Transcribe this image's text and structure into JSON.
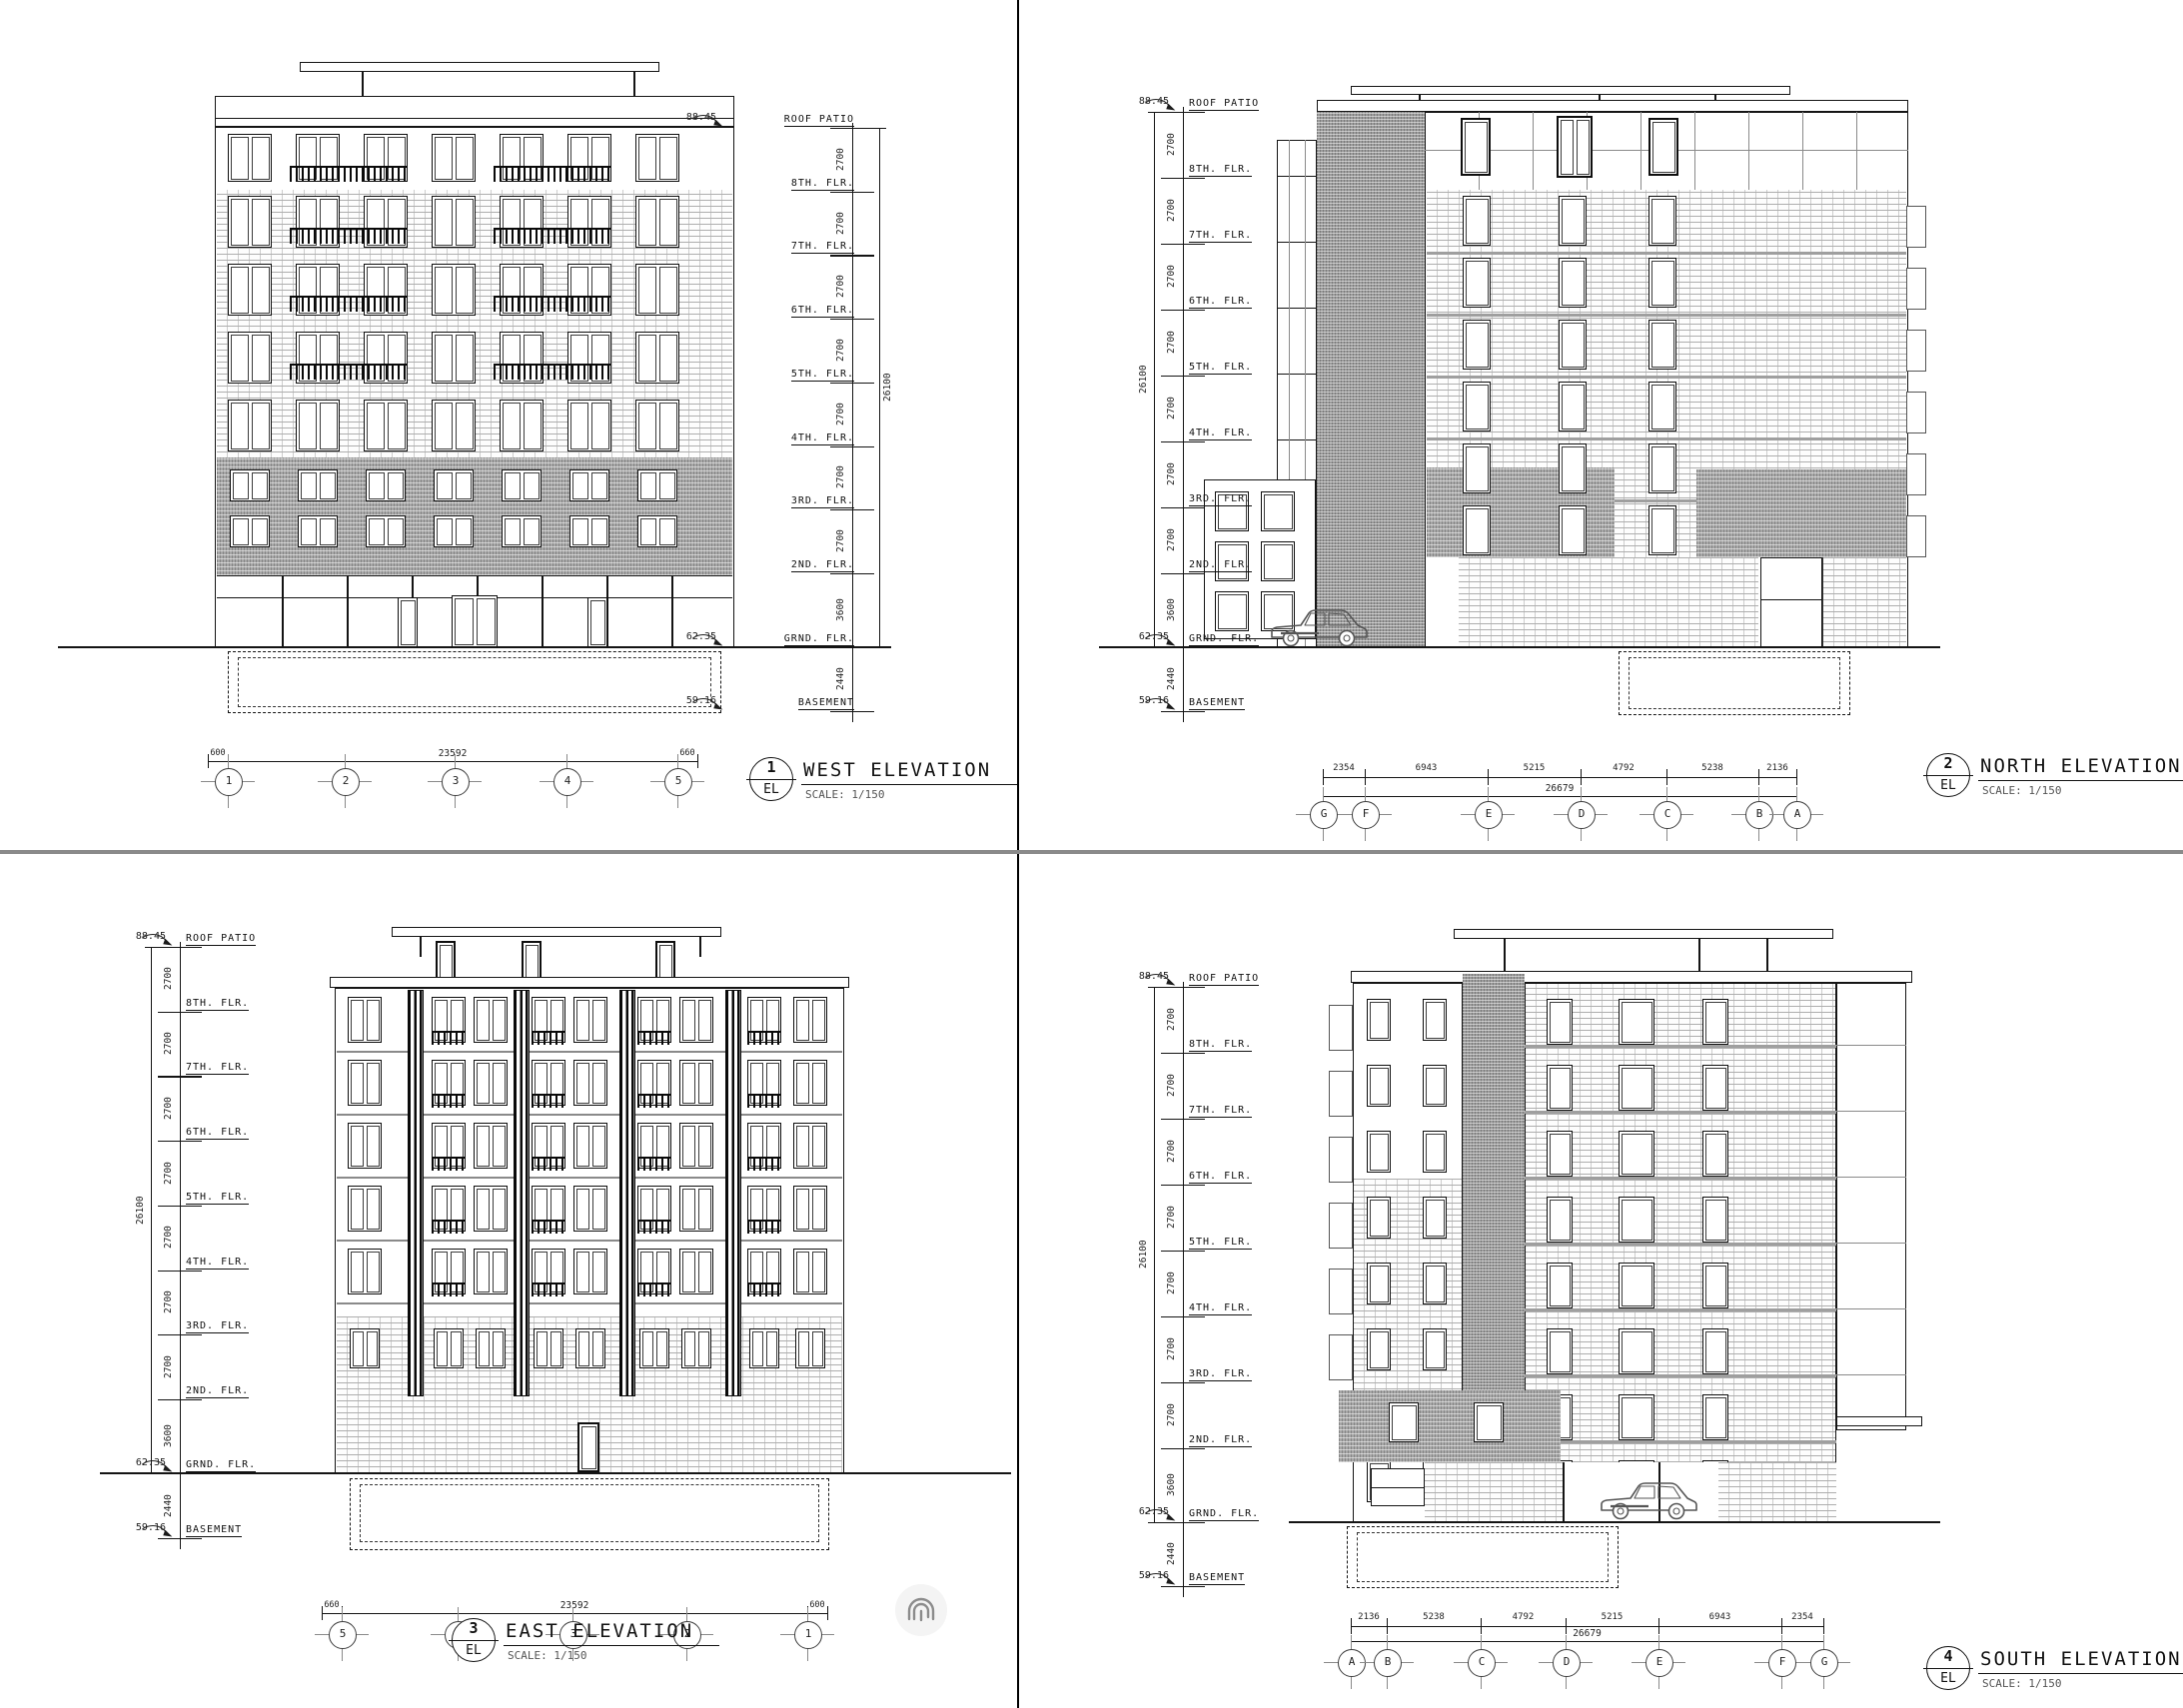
{
  "sheet": {
    "background": "#ffffff",
    "divider_vertical_color": "#000000",
    "divider_horizontal_color": "#8a8a8a",
    "line_color": "#141414"
  },
  "icons": {
    "watermark": "fingerprint-icon",
    "vehicle": "car-silhouette"
  },
  "levels": {
    "roof": {
      "label": "ROOF PATIO",
      "elevation": "88.45"
    },
    "floors": [
      {
        "label": "8TH. FLR.",
        "dim_above": "2700"
      },
      {
        "label": "7TH. FLR.",
        "dim_above": "2700"
      },
      {
        "label": "6TH. FLR.",
        "dim_above": "2700"
      },
      {
        "label": "5TH. FLR.",
        "dim_above": "2700"
      },
      {
        "label": "4TH. FLR.",
        "dim_above": "2700"
      },
      {
        "label": "3RD. FLR.",
        "dim_above": "2700"
      },
      {
        "label": "2ND. FLR.",
        "dim_above": "2700"
      }
    ],
    "ground": {
      "label": "GRND. FLR.",
      "elevation": "62.35",
      "dim_above": "3600"
    },
    "basement": {
      "label": "BASEMENT",
      "elevation": "59.16",
      "dim_above": "2440"
    },
    "overall_dim": "26100"
  },
  "views": [
    {
      "id": "west",
      "number": "1",
      "tag": "EL",
      "title": "WEST ELEVATION",
      "scale": "SCALE: 1/150",
      "grid_bubbles": [
        "1",
        "2",
        "3",
        "4",
        "5"
      ],
      "overall_dim": "23592",
      "end_dim_left": "600",
      "end_dim_right": "660"
    },
    {
      "id": "north",
      "number": "2",
      "tag": "EL",
      "title": "NORTH ELEVATION",
      "scale": "SCALE: 1/150",
      "grid_bubbles": [
        "G",
        "F",
        "E",
        "D",
        "C",
        "B",
        "A"
      ],
      "dims": [
        "2354",
        "6943",
        "5215",
        "4792",
        "5238",
        "2136"
      ],
      "overall_dim": "26679"
    },
    {
      "id": "east",
      "number": "3",
      "tag": "EL",
      "title": "EAST ELEVATION",
      "scale": "SCALE: 1/150",
      "grid_bubbles": [
        "5",
        "4",
        "3",
        "2",
        "1"
      ],
      "overall_dim": "23592",
      "end_dim_left": "660",
      "end_dim_right": "600"
    },
    {
      "id": "south",
      "number": "4",
      "tag": "EL",
      "title": "SOUTH ELEVATION",
      "scale": "SCALE: 1/150",
      "grid_bubbles": [
        "A",
        "B",
        "C",
        "D",
        "E",
        "F",
        "G"
      ],
      "dims": [
        "2136",
        "5238",
        "4792",
        "5215",
        "6943",
        "2354"
      ],
      "overall_dim": "26679"
    }
  ]
}
